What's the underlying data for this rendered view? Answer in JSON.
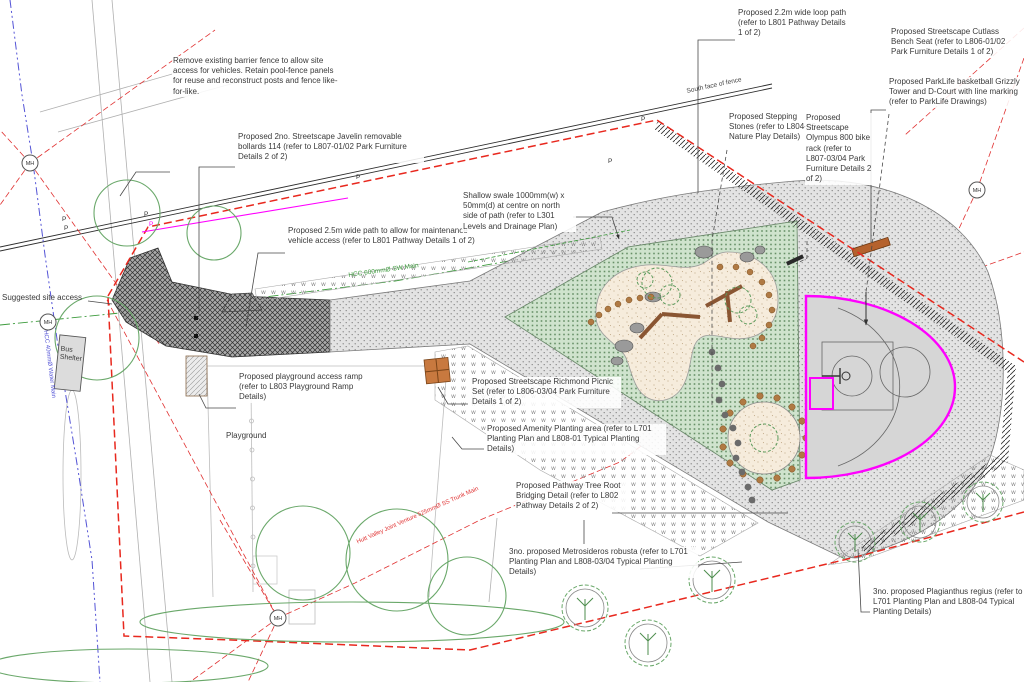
{
  "drawing": {
    "type": "Landscape development site plan",
    "annotations": {
      "remove_fence": "Remove existing barrier fence to allow site access for vehicles. Retain pool-fence panels for reuse and reconstruct posts and fence like-for-like.",
      "bollards": "Proposed 2no. Streetscape Javelin removable bollards 114 (refer to L807-01/02 Park Furniture Details 2 of 2)",
      "maintenance_path": "Proposed 2.5m wide path to allow for maintenance vehicle access (refer to L801 Pathway Details 1 of 2)",
      "swale": "Shallow swale 1000mm(w) x 50mm(d) at centre on north side of path (refer to L301 Levels and Drainage Plan)",
      "loop_path": "Proposed 2.2m wide loop path (refer to L801 Pathway Details 1 of 2)",
      "stepping_stones": "Proposed Stepping Stones (refer to L804-06 Nature Play Details)",
      "bike_rack": "Proposed Streetscape Olympus 800 bike rack (refer to L807-03/04 Park Furniture Details 2 of 2)",
      "bench": "Proposed Streetscape Cutlass Bench Seat (refer to L806-01/02 Park Furniture Details 1 of 2)",
      "basketball": "Proposed ParkLife basketball Grizzly Tower and D-Court with line marking (refer to ParkLife Drawings)",
      "picnic": "Proposed Streetscape Richmond Picnic Set (refer to L806-03/04 Park Furniture Details 1 of 2)",
      "amenity": "Proposed Amenity Planting area (refer to L701 Planting Plan and L808-01 Typical Planting Details)",
      "root_bridging": "Proposed Pathway Tree Root Bridging Detail (refer to L802 Pathway Details 2 of 2)",
      "metrosideros": "3no. proposed Metrosideros robusta (refer to L701 Planting Plan and L808-03/04 Typical Planting Details)",
      "plagianthus": "3no. proposed Plagianthus regius (refer to L701 Planting Plan and L808-04 Typical Planting Details)",
      "access_ramp": "Proposed playground access ramp (refer to L803 Playground Ramp Details)",
      "site_access": "Suggested site access"
    },
    "labels": {
      "playground": "Playground",
      "bus_shelter": "Bus Shelter",
      "south_fence": "South face of fence",
      "sw_main": "HCC 600mmØ SW Main",
      "water_main": "HCC 40mmØ Water Main",
      "trunk_main": "Hutt Valley Joint Venture 525mmØ SS Trunk Main",
      "manhole": "MH",
      "post": "P"
    },
    "colors": {
      "boundary": "#e8281e",
      "court_marking": "#ff00ff",
      "sw_main": "#3d9b3d",
      "water_main": "#5454d6",
      "planting": "#cfe3cd",
      "play_surface": "#f6ecdc",
      "timber": "#b5622d"
    }
  }
}
